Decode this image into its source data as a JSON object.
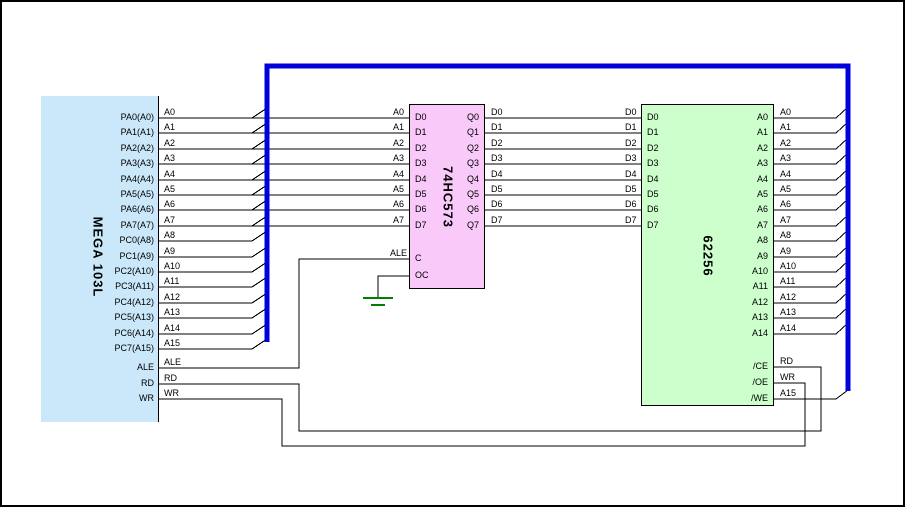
{
  "chips": {
    "mcu": {
      "title": "MEGA 103L",
      "fill": "#CAE8FA",
      "pins": [
        "PA0(A0)",
        "PA1(A1)",
        "PA2(A2)",
        "PA3(A3)",
        "PA4(A4)",
        "PA5(A5)",
        "PA6(A6)",
        "PA7(A7)",
        "PC0(A8)",
        "PC1(A9)",
        "PC2(A10)",
        "PC3(A11)",
        "PC4(A12)",
        "PC5(A13)",
        "PC6(A14)",
        "PC7(A15)",
        "ALE",
        "RD",
        "WR"
      ]
    },
    "latch": {
      "title": "74HC573",
      "fill": "#F9C9F9",
      "left_pins": [
        "D0",
        "D1",
        "D2",
        "D3",
        "D4",
        "D5",
        "D6",
        "D7",
        "C",
        "OC"
      ],
      "right_pins": [
        "Q0",
        "Q1",
        "Q2",
        "Q3",
        "Q4",
        "Q5",
        "Q6",
        "Q7"
      ]
    },
    "sram": {
      "title": "62256",
      "fill": "#CCFFCC",
      "left_pins": [
        "D0",
        "D1",
        "D2",
        "D3",
        "D4",
        "D5",
        "D6",
        "D7"
      ],
      "right_pins": [
        "A0",
        "A1",
        "A2",
        "A3",
        "A4",
        "A5",
        "A6",
        "A7",
        "A8",
        "A9",
        "A10",
        "A11",
        "A12",
        "A13",
        "A14",
        "/CE",
        "/OE",
        "/WE"
      ]
    }
  },
  "nets": {
    "mcu_out": [
      "A0",
      "A1",
      "A2",
      "A3",
      "A4",
      "A5",
      "A6",
      "A7",
      "A8",
      "A9",
      "A10",
      "A11",
      "A12",
      "A13",
      "A14",
      "A15",
      "ALE",
      "RD",
      "WR"
    ],
    "latch_in": [
      "A0",
      "A1",
      "A2",
      "A3",
      "A4",
      "A5",
      "A6",
      "A7",
      "ALE"
    ],
    "latch_out": [
      "D0",
      "D1",
      "D2",
      "D3",
      "D4",
      "D5",
      "D6",
      "D7"
    ],
    "sram_in": [
      "D0",
      "D1",
      "D2",
      "D3",
      "D4",
      "D5",
      "D6",
      "D7"
    ],
    "sram_addr": [
      "A0",
      "A1",
      "A2",
      "A3",
      "A4",
      "A5",
      "A6",
      "A7",
      "A8",
      "A9",
      "A10",
      "A11",
      "A12",
      "A13",
      "A14"
    ],
    "sram_ctrl": [
      "RD",
      "WR",
      "A15"
    ]
  },
  "colors": {
    "bus": "#0000DD",
    "wire": "#000000",
    "ground": "#008000"
  }
}
